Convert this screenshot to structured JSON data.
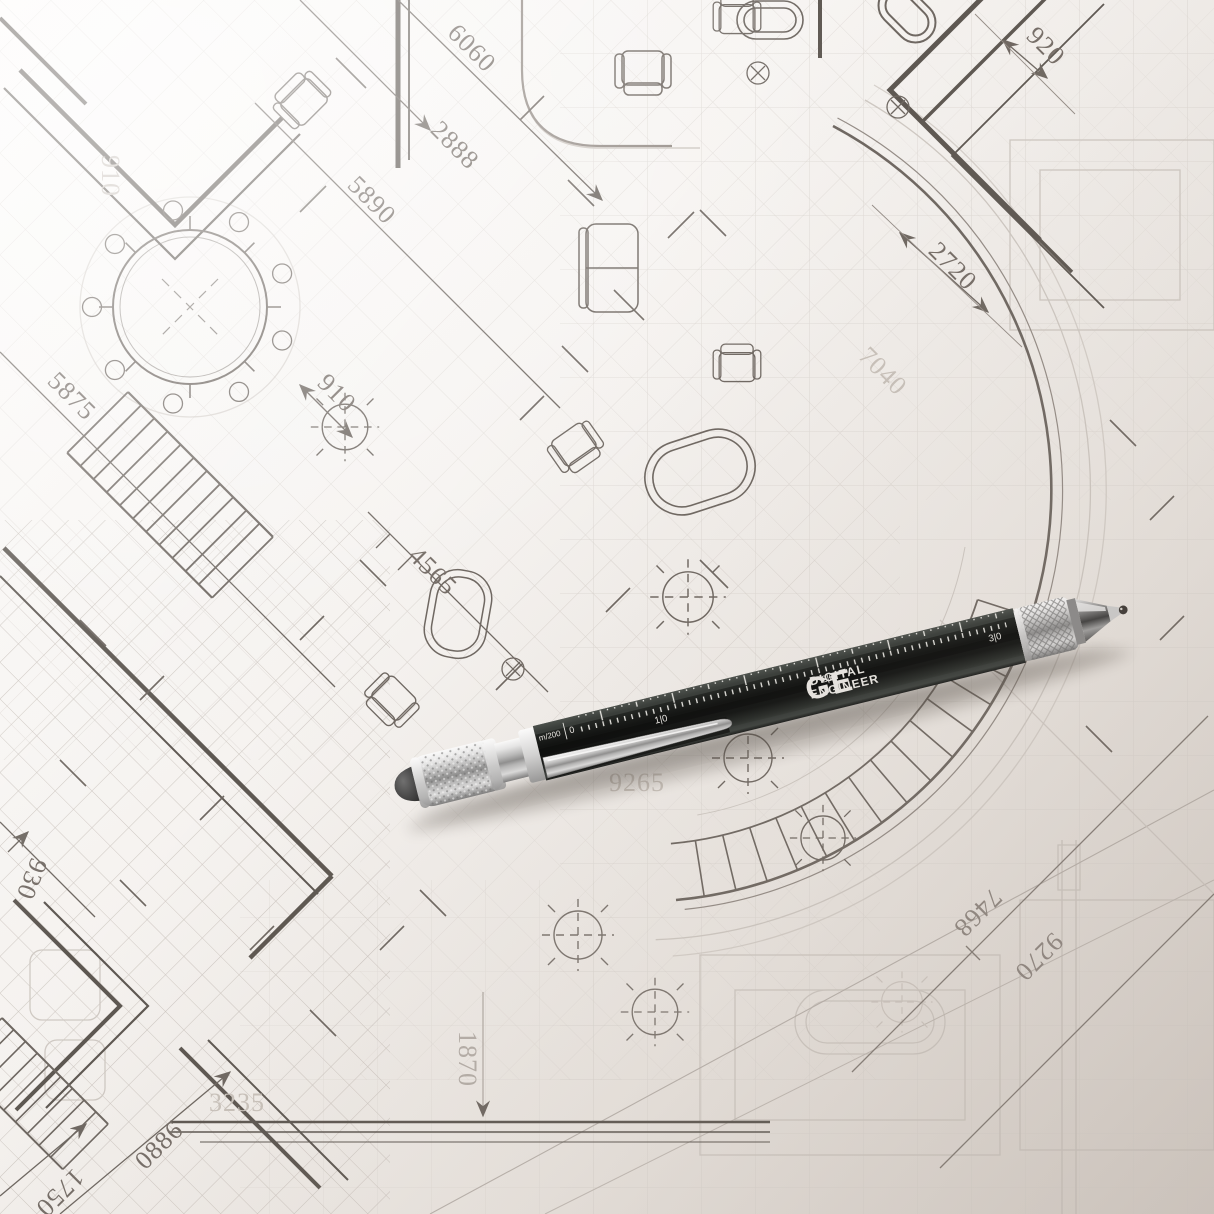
{
  "blueprint": {
    "dims": {
      "d6060": "6060",
      "d2888": "2888",
      "d5890": "5890",
      "d920": "920",
      "d2720": "2720",
      "d5875": "5875",
      "d910": "910",
      "d4565": "4565",
      "d7040": "7040",
      "d9265": "9265",
      "d7468": "7468",
      "d9270": "9270",
      "d1870": "1870",
      "d3235": "3235",
      "d0886": "0886",
      "d1750": "1750",
      "d930": "930",
      "d910_ghost": "910"
    }
  },
  "pen": {
    "brand": "GE",
    "brand_line1": "DIGITAL",
    "brand_line2": "ENGINEER",
    "scale_label": "m/200",
    "scale_zero": "0",
    "ruler_marks": [
      "1|0",
      "2|0",
      "3|0"
    ]
  },
  "colors": {
    "paper": "#f6f3f0",
    "ink_dark": "#6e6761",
    "ink_light": "#cfc9c3",
    "pen_black": "#121413",
    "chrome": "#c9c9c9",
    "stylus_rubber": "#3f3f3f"
  }
}
